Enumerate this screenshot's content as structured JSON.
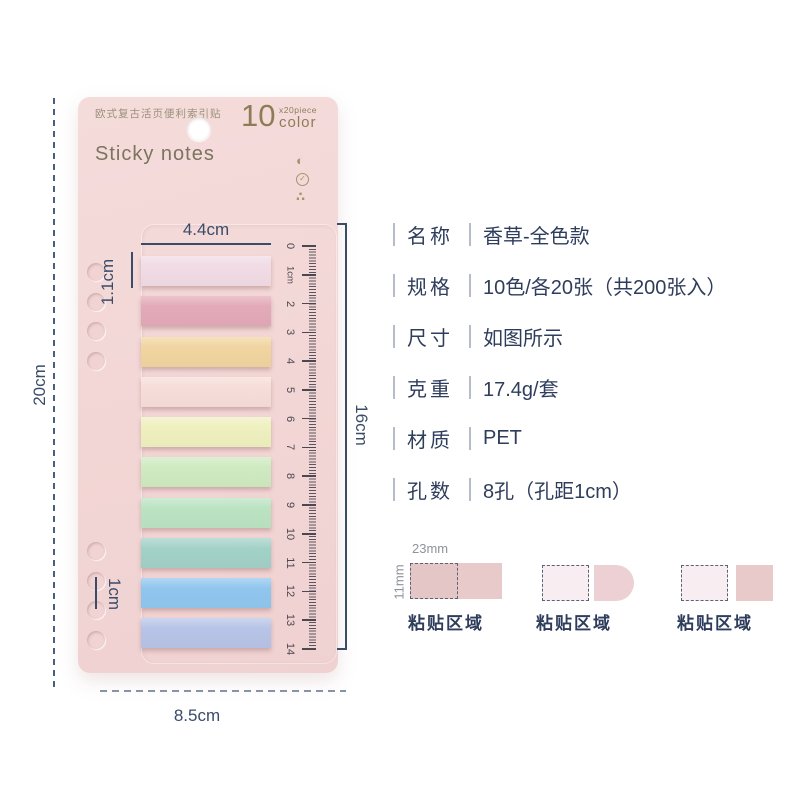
{
  "card": {
    "header_label": "欧式复古活页便利索引贴",
    "count": {
      "number": "10",
      "multiplier": "x20piece",
      "unit": "color"
    },
    "brand": "Sticky notes",
    "icons": [
      {
        "name": "half-moon-icon",
        "glyph": "◐"
      },
      {
        "name": "check-circle-icon",
        "glyph": "✓"
      },
      {
        "name": "dots-triangle-icon",
        "glyph": "∴"
      }
    ],
    "strip_colors": [
      "#f1dbe4",
      "#e3aab9",
      "#f1d5a0",
      "#f6ddd9",
      "#eff0bf",
      "#cfeac0",
      "#bbe3c2",
      "#a2d1c8",
      "#90c6ee",
      "#b8c4e7"
    ],
    "ruler_labels": [
      "0",
      "1cm",
      "2",
      "3",
      "4",
      "5",
      "6",
      "7",
      "8",
      "9",
      "10",
      "11",
      "12",
      "13",
      "14"
    ]
  },
  "dimensions": {
    "strip_width": "4.4cm",
    "strip_height": "1.1cm",
    "card_height": "20cm",
    "ruler_span": "16cm",
    "hole_spacing": "1cm",
    "card_width": "8.5cm"
  },
  "specs": [
    {
      "label": "名称",
      "value": "香草-全色款"
    },
    {
      "label": "规格",
      "value": "10色/各20张（共200张入）"
    },
    {
      "label": "尺寸",
      "value": "如图所示"
    },
    {
      "label": "克重",
      "value": "17.4g/套"
    },
    {
      "label": "材质",
      "value": "PET"
    },
    {
      "label": "孔数",
      "value": "8孔（孔距1cm）"
    }
  ],
  "adhesive_diagrams": {
    "width_label": "23mm",
    "height_label": "11mm",
    "items": [
      {
        "label": "粘贴区域",
        "style": "full-strip"
      },
      {
        "label": "粘贴区域",
        "style": "rounded-tab"
      },
      {
        "label": "粘贴区域",
        "style": "square-tab"
      }
    ]
  },
  "colors": {
    "card_bg": "#f2d7d6",
    "accent_text": "#3a4c68",
    "spec_text": "#2f3d5c",
    "brand_text": "#7b745e",
    "gold_text": "#8d7d57",
    "gray_label": "#8d929b",
    "diagram_pink": "#e9caca",
    "diagram_light": "#f8edf0",
    "diagram_tab": "#ecd0d3"
  }
}
